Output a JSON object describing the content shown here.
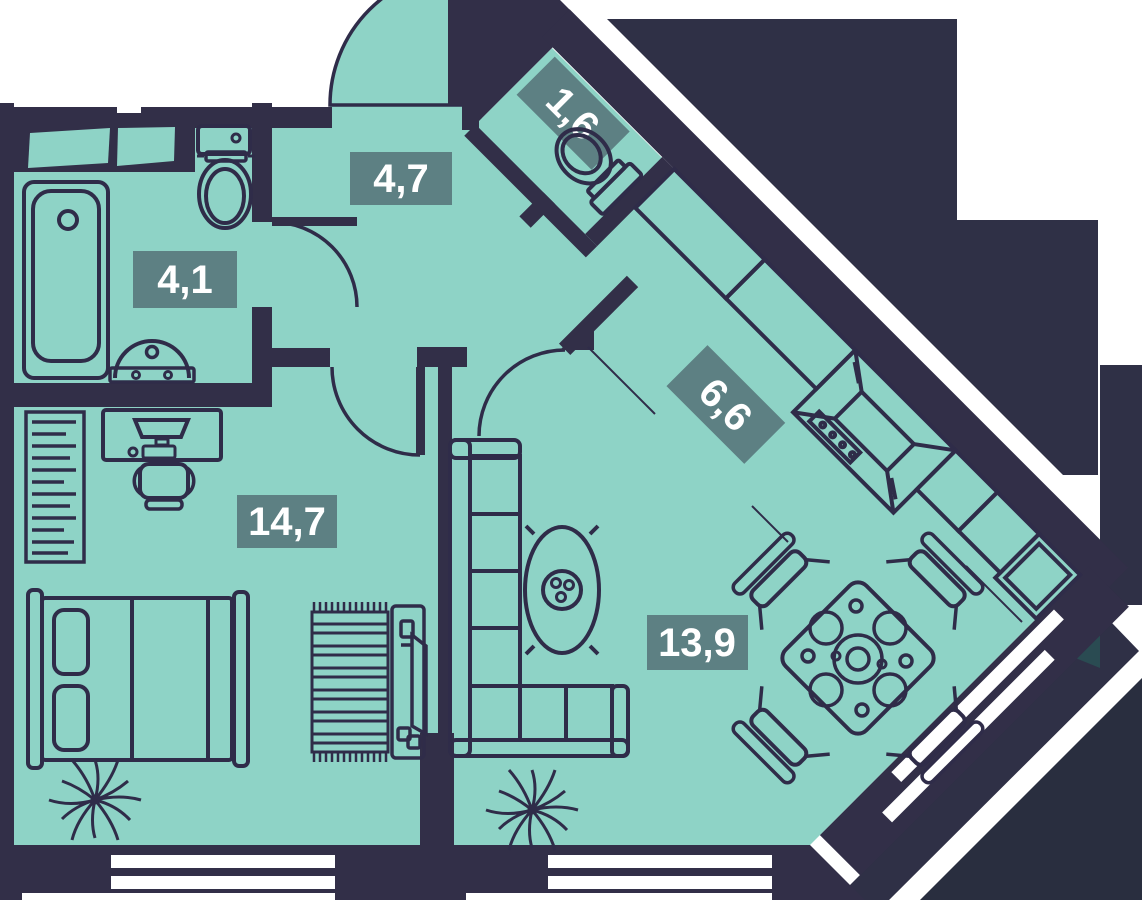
{
  "plan": {
    "type": "apartment-floor-plan",
    "rooms": [
      {
        "id": "hallway",
        "area_label": "4,7"
      },
      {
        "id": "wc",
        "area_label": "1,6"
      },
      {
        "id": "bathroom",
        "area_label": "4,1"
      },
      {
        "id": "kitchen",
        "area_label": "6,6"
      },
      {
        "id": "bedroom",
        "area_label": "14,7"
      },
      {
        "id": "living-room",
        "area_label": "13,9"
      }
    ],
    "colors": {
      "floor": "#8ed3c6",
      "walls": "#322f48",
      "outline": "#2f2c49",
      "label_background": "#5d8083",
      "label_text": "#ffffff",
      "accent_triangle": "#2a4b52",
      "window": "#ffffff"
    }
  }
}
